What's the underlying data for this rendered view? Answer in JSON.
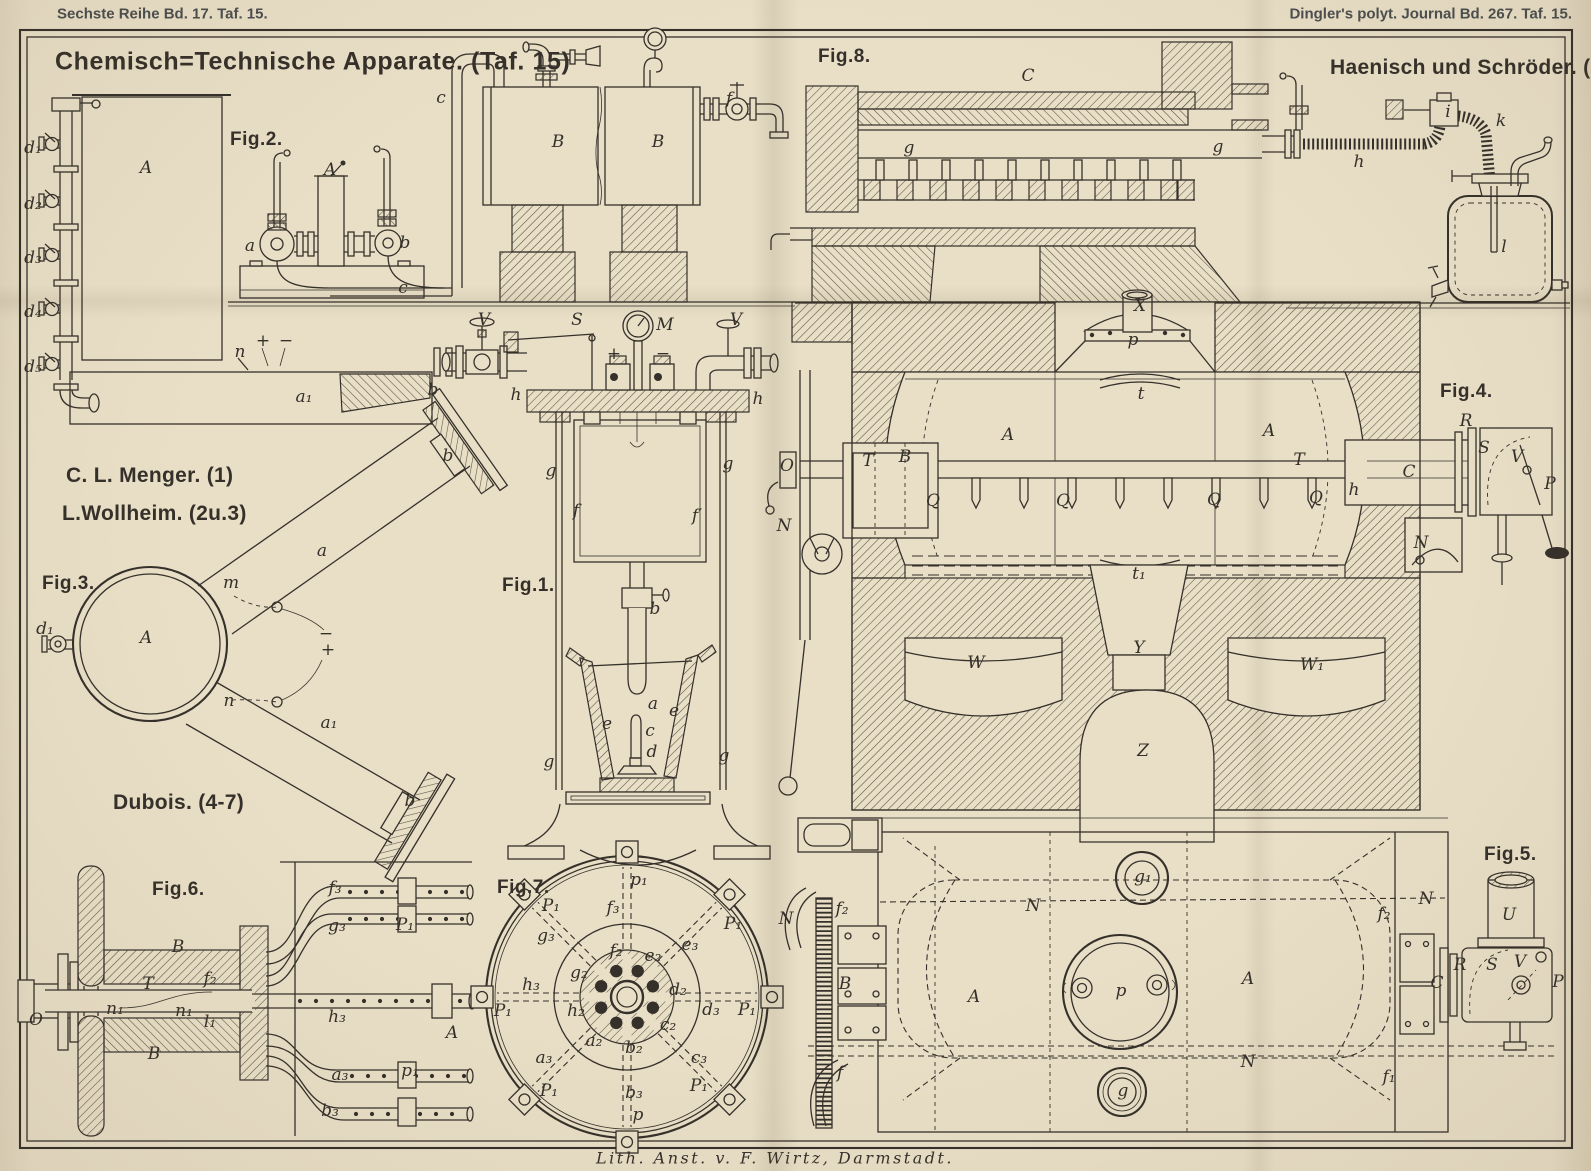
{
  "colors": {
    "paper": "#e9dfc7",
    "ink": "#35302a",
    "hatch": "#57503f",
    "hdr": "#4b4d4f"
  },
  "plate": {
    "header": {
      "left": "Sechste Reihe Bd. 17. Taf. 15.",
      "right": "Dingler's polyt. Journal Bd. 267. Taf. 15."
    },
    "title": "Chemisch=Technische Apparate. (Taf. 15)",
    "footer": "Lith. Anst. v. F. Wirtz, Darmstadt.",
    "attributions": [
      {
        "t": "C. L. Menger. (1)",
        "x": 66,
        "y": 476
      },
      {
        "t": "L.Wollheim. (2u.3)",
        "x": 62,
        "y": 514
      },
      {
        "t": "Dubois. (4-7)",
        "x": 113,
        "y": 803
      },
      {
        "t": "Haenisch und Schröder. (8)",
        "x": 1330,
        "y": 68
      }
    ],
    "figures": [
      {
        "id": "fig1",
        "label": "Fig.1.",
        "x": 502,
        "y": 586,
        "parts": [
          {
            "t": "V",
            "x": 484,
            "y": 320
          },
          {
            "t": "S",
            "x": 577,
            "y": 320
          },
          {
            "t": "M",
            "x": 665,
            "y": 325
          },
          {
            "t": "V",
            "x": 736,
            "y": 320
          },
          {
            "t": "+",
            "x": 614,
            "y": 354
          },
          {
            "t": "−",
            "x": 663,
            "y": 354
          },
          {
            "t": "h",
            "x": 516,
            "y": 395
          },
          {
            "t": "h",
            "x": 758,
            "y": 399
          },
          {
            "t": "g",
            "x": 551,
            "y": 471
          },
          {
            "t": "g",
            "x": 728,
            "y": 464
          },
          {
            "t": "f",
            "x": 576,
            "y": 511
          },
          {
            "t": "f′",
            "x": 697,
            "y": 516
          },
          {
            "t": "b",
            "x": 655,
            "y": 609
          },
          {
            "t": "a",
            "x": 653,
            "y": 704
          },
          {
            "t": "e",
            "x": 607,
            "y": 724
          },
          {
            "t": "e",
            "x": 674,
            "y": 711
          },
          {
            "t": "c",
            "x": 650,
            "y": 731
          },
          {
            "t": "d",
            "x": 652,
            "y": 752
          },
          {
            "t": "g",
            "x": 549,
            "y": 762
          },
          {
            "t": "g",
            "x": 724,
            "y": 756
          }
        ]
      },
      {
        "id": "fig2",
        "label": "Fig.2.",
        "x": 230,
        "y": 140,
        "parts": [
          {
            "t": "d₁",
            "x": 33,
            "y": 148
          },
          {
            "t": "d₂",
            "x": 33,
            "y": 204
          },
          {
            "t": "d₃",
            "x": 33,
            "y": 258
          },
          {
            "t": "d₄",
            "x": 33,
            "y": 312
          },
          {
            "t": "d₅",
            "x": 33,
            "y": 367
          },
          {
            "t": "A",
            "x": 146,
            "y": 168
          },
          {
            "t": "n",
            "x": 240,
            "y": 352
          },
          {
            "t": "a₁",
            "x": 304,
            "y": 397
          },
          {
            "t": "b",
            "x": 433,
            "y": 390
          },
          {
            "t": "+",
            "x": 263,
            "y": 341
          },
          {
            "t": "−",
            "x": 286,
            "y": 341
          },
          {
            "t": "a",
            "x": 250,
            "y": 246
          },
          {
            "t": "A",
            "x": 330,
            "y": 170
          },
          {
            "t": "b",
            "x": 405,
            "y": 243
          },
          {
            "t": "c",
            "x": 403,
            "y": 288
          },
          {
            "t": "c",
            "x": 441,
            "y": 98
          },
          {
            "t": "B",
            "x": 558,
            "y": 142
          },
          {
            "t": "B",
            "x": 658,
            "y": 142
          },
          {
            "t": "f",
            "x": 729,
            "y": 99
          }
        ]
      },
      {
        "id": "fig3",
        "label": "Fig.3.",
        "x": 42,
        "y": 584,
        "parts": [
          {
            "t": "d₁",
            "x": 45,
            "y": 629
          },
          {
            "t": "A",
            "x": 146,
            "y": 638
          },
          {
            "t": "m",
            "x": 231,
            "y": 583
          },
          {
            "t": "n",
            "x": 229,
            "y": 701
          },
          {
            "t": "a",
            "x": 322,
            "y": 551
          },
          {
            "t": "a₁",
            "x": 329,
            "y": 723
          },
          {
            "t": "b",
            "x": 448,
            "y": 456
          },
          {
            "t": "b",
            "x": 410,
            "y": 801
          },
          {
            "t": "−",
            "x": 326,
            "y": 634
          },
          {
            "t": "+",
            "x": 328,
            "y": 650
          }
        ]
      },
      {
        "id": "fig4",
        "label": "Fig.4.",
        "x": 1440,
        "y": 392,
        "parts": [
          {
            "t": "X",
            "x": 1140,
            "y": 306
          },
          {
            "t": "p",
            "x": 1133,
            "y": 340
          },
          {
            "t": "t",
            "x": 1141,
            "y": 394
          },
          {
            "t": "A",
            "x": 1008,
            "y": 435
          },
          {
            "t": "A",
            "x": 1269,
            "y": 431
          },
          {
            "t": "T",
            "x": 868,
            "y": 461
          },
          {
            "t": "B",
            "x": 905,
            "y": 457
          },
          {
            "t": "T",
            "x": 1299,
            "y": 460
          },
          {
            "t": "O",
            "x": 787,
            "y": 466
          },
          {
            "t": "N",
            "x": 784,
            "y": 526
          },
          {
            "t": "Q",
            "x": 933,
            "y": 501
          },
          {
            "t": "Q",
            "x": 1063,
            "y": 501
          },
          {
            "t": "Q",
            "x": 1214,
            "y": 500
          },
          {
            "t": "Q",
            "x": 1316,
            "y": 498
          },
          {
            "t": "h",
            "x": 1354,
            "y": 490
          },
          {
            "t": "C",
            "x": 1409,
            "y": 472
          },
          {
            "t": "R",
            "x": 1466,
            "y": 421
          },
          {
            "t": "S",
            "x": 1484,
            "y": 448
          },
          {
            "t": "V",
            "x": 1517,
            "y": 457
          },
          {
            "t": "P",
            "x": 1550,
            "y": 484
          },
          {
            "t": "N",
            "x": 1421,
            "y": 543
          },
          {
            "t": "t₁",
            "x": 1139,
            "y": 574
          },
          {
            "t": "W",
            "x": 976,
            "y": 663
          },
          {
            "t": "Y",
            "x": 1139,
            "y": 648
          },
          {
            "t": "W₁",
            "x": 1312,
            "y": 665
          },
          {
            "t": "Z",
            "x": 1143,
            "y": 751
          }
        ]
      },
      {
        "id": "fig5",
        "label": "Fig.5.",
        "x": 1484,
        "y": 855,
        "parts": [
          {
            "t": "N",
            "x": 786,
            "y": 919
          },
          {
            "t": "f₂",
            "x": 842,
            "y": 909
          },
          {
            "t": "B",
            "x": 845,
            "y": 984
          },
          {
            "t": "f",
            "x": 840,
            "y": 1073
          },
          {
            "t": "A",
            "x": 974,
            "y": 997
          },
          {
            "t": "p",
            "x": 1121,
            "y": 991
          },
          {
            "t": "A",
            "x": 1248,
            "y": 979
          },
          {
            "t": "g₁",
            "x": 1143,
            "y": 877
          },
          {
            "t": "g",
            "x": 1123,
            "y": 1091
          },
          {
            "t": "N",
            "x": 1033,
            "y": 906
          },
          {
            "t": "N",
            "x": 1248,
            "y": 1062
          },
          {
            "t": "N",
            "x": 1426,
            "y": 899
          },
          {
            "t": "f₂",
            "x": 1384,
            "y": 914
          },
          {
            "t": "f₁",
            "x": 1389,
            "y": 1077
          },
          {
            "t": "C",
            "x": 1437,
            "y": 983
          },
          {
            "t": "R",
            "x": 1460,
            "y": 965
          },
          {
            "t": "S",
            "x": 1492,
            "y": 965
          },
          {
            "t": "V",
            "x": 1520,
            "y": 962
          },
          {
            "t": "P",
            "x": 1558,
            "y": 982
          },
          {
            "t": "U",
            "x": 1509,
            "y": 915
          }
        ]
      },
      {
        "id": "fig6",
        "label": "Fig.6.",
        "x": 152,
        "y": 890,
        "parts": [
          {
            "t": "O",
            "x": 36,
            "y": 1020
          },
          {
            "t": "B",
            "x": 178,
            "y": 947
          },
          {
            "t": "T",
            "x": 148,
            "y": 984
          },
          {
            "t": "B",
            "x": 154,
            "y": 1054
          },
          {
            "t": "n₁",
            "x": 115,
            "y": 1009
          },
          {
            "t": "n₁",
            "x": 184,
            "y": 1011
          },
          {
            "t": "f₂",
            "x": 210,
            "y": 979
          },
          {
            "t": "l₁",
            "x": 210,
            "y": 1022
          },
          {
            "t": "f₃",
            "x": 335,
            "y": 888
          },
          {
            "t": "g₃",
            "x": 337,
            "y": 926
          },
          {
            "t": "P₁",
            "x": 405,
            "y": 925
          },
          {
            "t": "h₃",
            "x": 337,
            "y": 1017
          },
          {
            "t": "A",
            "x": 452,
            "y": 1033
          },
          {
            "t": "a₃",
            "x": 340,
            "y": 1075
          },
          {
            "t": "p₁",
            "x": 410,
            "y": 1071
          },
          {
            "t": "b₃",
            "x": 330,
            "y": 1111
          }
        ]
      },
      {
        "id": "fig7",
        "label": "Fig.7.",
        "x": 497,
        "y": 888,
        "parts": [
          {
            "t": "p₁",
            "x": 639,
            "y": 880
          },
          {
            "t": "P₁",
            "x": 551,
            "y": 906
          },
          {
            "t": "P₁",
            "x": 733,
            "y": 924
          },
          {
            "t": "f₃",
            "x": 613,
            "y": 908
          },
          {
            "t": "g₃",
            "x": 546,
            "y": 936
          },
          {
            "t": "e₃",
            "x": 690,
            "y": 945
          },
          {
            "t": "f₂",
            "x": 616,
            "y": 951
          },
          {
            "t": "e₂",
            "x": 653,
            "y": 956
          },
          {
            "t": "g₂",
            "x": 579,
            "y": 973
          },
          {
            "t": "h₃",
            "x": 531,
            "y": 985
          },
          {
            "t": "d₂",
            "x": 678,
            "y": 990
          },
          {
            "t": "h₂",
            "x": 576,
            "y": 1011
          },
          {
            "t": "d₃",
            "x": 711,
            "y": 1010
          },
          {
            "t": "P₁",
            "x": 747,
            "y": 1010
          },
          {
            "t": "P₁",
            "x": 503,
            "y": 1011
          },
          {
            "t": "c₂",
            "x": 668,
            "y": 1025
          },
          {
            "t": "a₂",
            "x": 594,
            "y": 1041
          },
          {
            "t": "b₂",
            "x": 634,
            "y": 1048
          },
          {
            "t": "a₃",
            "x": 544,
            "y": 1058
          },
          {
            "t": "c₃",
            "x": 699,
            "y": 1058
          },
          {
            "t": "P₁",
            "x": 549,
            "y": 1091
          },
          {
            "t": "P₁",
            "x": 699,
            "y": 1086
          },
          {
            "t": "b₃",
            "x": 634,
            "y": 1093
          },
          {
            "t": "p",
            "x": 638,
            "y": 1115
          }
        ]
      },
      {
        "id": "fig8",
        "label": "Fig.8.",
        "x": 818,
        "y": 57,
        "parts": [
          {
            "t": "C",
            "x": 1028,
            "y": 76
          },
          {
            "t": "g",
            "x": 909,
            "y": 148
          },
          {
            "t": "g",
            "x": 1218,
            "y": 147
          },
          {
            "t": "h",
            "x": 1359,
            "y": 162
          },
          {
            "t": "i",
            "x": 1448,
            "y": 112
          },
          {
            "t": "k",
            "x": 1501,
            "y": 121
          },
          {
            "t": "l",
            "x": 1504,
            "y": 247
          }
        ]
      }
    ]
  }
}
